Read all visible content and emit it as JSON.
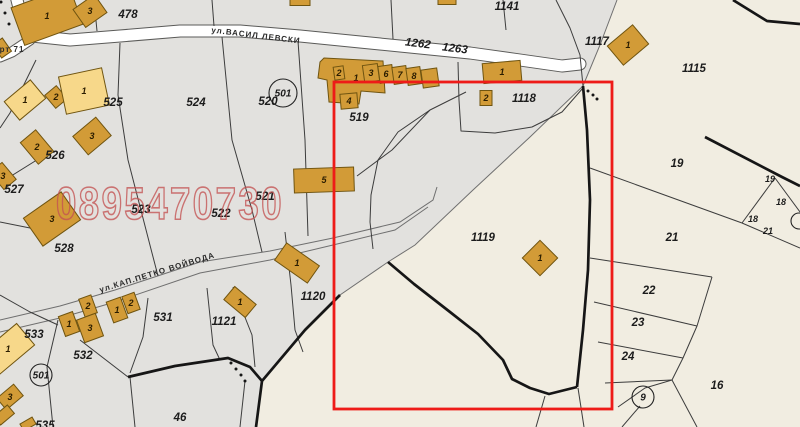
{
  "map": {
    "title": "cadastral-map",
    "colors": {
      "bg": "#e2e1de",
      "cream": "#f1ede1",
      "cream_edge": "#9a9a94",
      "road_fill": "#ffffff",
      "road_edge": "#5a5a58",
      "gray_line": "#6f6f6f",
      "thin_line": "#3c3c3c",
      "thick_line": "#161616",
      "building_fill": "#d29b37",
      "building_fill_light": "#f7d88a",
      "building_stroke": "#6f5410",
      "red_box": "#ee1b18",
      "watermark": "#c45353",
      "label": "#1c1c1c"
    },
    "cream_polygon": "617,0 800,0 800,427 256,427 262,381 305,330 340,295 388,262 415,245 473,190 530,137 583,86 600,45",
    "roads": [
      {
        "pts": "16,-4 22,20 32,36 70,40 120,36 180,31 240,31 300,36 360,42 420,48 470,53 520,60 562,66 580,64",
        "w": 11
      },
      {
        "pts": "30,40 12,52 0,57",
        "w": 9
      }
    ],
    "gray_lines": [
      "617,0 600,45 583,86 530,137 473,190 415,245 388,262 340,295 305,330 262,381 256,427",
      "0,320 60,306 115,290 200,262 270,251 333,238 400,222 433,200 437,187",
      "0,332 60,318 115,302 200,273 270,260 333,245 395,230 428,207"
    ],
    "thin_lines": [
      "120,43 118,95 128,160 152,253 158,276",
      "36,60 10,113 0,128",
      "40,158 0,183",
      "0,222 50,232",
      "222,37 232,140 252,210 262,252",
      "298,41 305,140 308,236",
      "466,92 430,110 398,132 378,160 371,195 370,222 373,249",
      "357,176 392,150 430,110",
      "458,62 459,100 461,131 495,133 532,127 562,112 583,88",
      "285,232 291,285 295,330 303,352",
      "148,298 143,337 130,373",
      "207,288 213,345 220,360",
      "233,287 252,335 255,367",
      "58,320 47,367 53,427",
      "80,340 128,377",
      "130,377 135,427",
      "245,381 240,427",
      "0,295 30,312 58,325",
      "590,168 742,223",
      "742,223 775,178",
      "775,178 800,212",
      "742,223 800,248",
      "590,258 712,277",
      "594,302 697,326",
      "598,342 683,358",
      "605,383 672,380",
      "712,277 697,326 683,358 672,380 645,388 618,407",
      "640,406 622,427",
      "672,380 697,427",
      "578,388 584,427",
      "545,396 536,427",
      "556,0 570,28 580,55 583,86",
      "97,31 94,0",
      "212,0 214,26",
      "391,0 393,39",
      "503,0 506,30"
    ],
    "thick_lines": [
      "733,0 767,21 800,24",
      "705,137 782,177 800,186",
      "583,86 587,130 590,200 588,270 583,330 577,387",
      "388,262 414,284 450,312 478,334 503,360 512,379 530,388 549,394 577,387",
      "128,377 175,366 228,358 250,367 262,381",
      "340,295 305,330 262,381 256,427"
    ],
    "dots": [
      [
        1,
        2
      ],
      [
        5,
        13
      ],
      [
        9,
        24
      ],
      [
        588,
        91
      ],
      [
        593,
        95
      ],
      [
        597,
        99
      ],
      [
        231,
        363
      ],
      [
        236,
        369
      ],
      [
        241,
        375
      ],
      [
        245,
        381
      ]
    ],
    "buildings": [
      {
        "x": 47,
        "y": 16,
        "w": 62,
        "h": 40,
        "r": -20,
        "l": "1"
      },
      {
        "x": 90,
        "y": 11,
        "w": 26,
        "h": 22,
        "r": -35,
        "l": "3"
      },
      {
        "x": 2,
        "y": 48,
        "w": 12,
        "h": 16,
        "r": -35,
        "l": ""
      },
      {
        "x": 25,
        "y": 100,
        "w": 34,
        "h": 24,
        "r": -40,
        "l": "1",
        "lt": 1
      },
      {
        "x": 56,
        "y": 97,
        "w": 15,
        "h": 17,
        "r": -40,
        "l": "2"
      },
      {
        "x": 84,
        "y": 91,
        "w": 44,
        "h": 38,
        "r": -12,
        "l": "1",
        "lt": 1
      },
      {
        "x": 92,
        "y": 136,
        "w": 30,
        "h": 24,
        "r": -40,
        "l": "3"
      },
      {
        "x": 37,
        "y": 147,
        "w": 20,
        "h": 28,
        "r": -40,
        "l": "2"
      },
      {
        "x": 3,
        "y": 176,
        "w": 16,
        "h": 22,
        "r": -40,
        "l": "3"
      },
      {
        "x": 52,
        "y": 219,
        "w": 46,
        "h": 34,
        "r": -35,
        "l": "3"
      },
      {
        "x": 8,
        "y": 349,
        "w": 46,
        "h": 28,
        "r": -40,
        "l": "1",
        "lt": 1
      },
      {
        "x": 10,
        "y": 397,
        "w": 22,
        "h": 15,
        "r": -40,
        "l": "3"
      },
      {
        "x": 4,
        "y": 415,
        "w": 18,
        "h": 11,
        "r": -40,
        "l": ""
      },
      {
        "x": 28,
        "y": 424,
        "w": 14,
        "h": 8,
        "r": -30,
        "l": ""
      },
      {
        "x": 88,
        "y": 306,
        "w": 13,
        "h": 19,
        "r": -20,
        "l": "2"
      },
      {
        "x": 69,
        "y": 324,
        "w": 15,
        "h": 21,
        "r": -20,
        "l": "1"
      },
      {
        "x": 90,
        "y": 328,
        "w": 20,
        "h": 24,
        "r": -20,
        "l": "3"
      },
      {
        "x": 117,
        "y": 310,
        "w": 15,
        "h": 22,
        "r": -20,
        "l": "1"
      },
      {
        "x": 131,
        "y": 303,
        "w": 13,
        "h": 18,
        "r": -20,
        "l": "2"
      },
      {
        "x": 240,
        "y": 302,
        "w": 17,
        "h": 28,
        "r": -50,
        "l": "1"
      },
      {
        "pts": "324,58 383,61 385,93 361,91 359,104 329,102 327,80 318,78 320,62",
        "l": "1",
        "lx": 356,
        "ly": 78
      },
      {
        "x": 339,
        "y": 73,
        "w": 10,
        "h": 13,
        "r": -8,
        "l": "2"
      },
      {
        "x": 371,
        "y": 73,
        "w": 15,
        "h": 17,
        "r": -8,
        "l": "3"
      },
      {
        "x": 386,
        "y": 74,
        "w": 14,
        "h": 17,
        "r": -8,
        "l": "6"
      },
      {
        "x": 400,
        "y": 75,
        "w": 14,
        "h": 17,
        "r": -8,
        "l": "7"
      },
      {
        "x": 414,
        "y": 76,
        "w": 14,
        "h": 17,
        "r": -8,
        "l": "8"
      },
      {
        "x": 430,
        "y": 78,
        "w": 16,
        "h": 18,
        "r": -8,
        "l": ""
      },
      {
        "x": 349,
        "y": 101,
        "w": 17,
        "h": 15,
        "r": -5,
        "l": "4"
      },
      {
        "x": 502,
        "y": 72,
        "w": 38,
        "h": 20,
        "r": -5,
        "l": "1"
      },
      {
        "x": 486,
        "y": 98,
        "w": 12,
        "h": 15,
        "r": 0,
        "l": "2"
      },
      {
        "x": 324,
        "y": 180,
        "w": 60,
        "h": 24,
        "r": -2,
        "l": "5"
      },
      {
        "x": 297,
        "y": 263,
        "w": 21,
        "h": 40,
        "r": -55,
        "l": "1"
      },
      {
        "x": 540,
        "y": 258,
        "w": 25,
        "h": 25,
        "r": 45,
        "l": "1"
      },
      {
        "x": 628,
        "y": 45,
        "w": 33,
        "h": 25,
        "r": -40,
        "l": "1"
      },
      {
        "x": 300,
        "y": 2,
        "w": 20,
        "h": 7,
        "r": 0,
        "l": ""
      },
      {
        "x": 447,
        "y": 2,
        "w": 18,
        "h": 5,
        "r": 0,
        "l": ""
      }
    ],
    "circles": [
      {
        "x": 283,
        "y": 93,
        "rad": 14,
        "l": "501"
      },
      {
        "x": 41,
        "y": 375,
        "rad": 11,
        "l": "501"
      },
      {
        "x": 643,
        "y": 397,
        "rad": 11,
        "l": "9"
      },
      {
        "x": 799,
        "y": 221,
        "rad": 8,
        "l": ""
      }
    ],
    "parcel_labels": [
      {
        "t": "478",
        "x": 128,
        "y": 14
      },
      {
        "t": "1141",
        "x": 507,
        "y": 6
      },
      {
        "t": "1262",
        "x": 418,
        "y": 43,
        "rot": 7
      },
      {
        "t": "1263",
        "x": 455,
        "y": 48,
        "rot": 7
      },
      {
        "t": "1117",
        "x": 597,
        "y": 41
      },
      {
        "t": "1115",
        "x": 694,
        "y": 68
      },
      {
        "t": "1118",
        "x": 524,
        "y": 98
      },
      {
        "t": "519",
        "x": 359,
        "y": 117
      },
      {
        "t": "520",
        "x": 268,
        "y": 101
      },
      {
        "t": "525",
        "x": 113,
        "y": 102
      },
      {
        "t": "524",
        "x": 196,
        "y": 102
      },
      {
        "t": "521",
        "x": 265,
        "y": 196
      },
      {
        "t": "523",
        "x": 141,
        "y": 209
      },
      {
        "t": "522",
        "x": 221,
        "y": 213
      },
      {
        "t": "526",
        "x": 55,
        "y": 155
      },
      {
        "t": "527",
        "x": 14,
        "y": 189
      },
      {
        "t": "528",
        "x": 64,
        "y": 248
      },
      {
        "t": "533",
        "x": 34,
        "y": 334
      },
      {
        "t": "532",
        "x": 83,
        "y": 355
      },
      {
        "t": "531",
        "x": 163,
        "y": 317
      },
      {
        "t": "1121",
        "x": 224,
        "y": 321
      },
      {
        "t": "1120",
        "x": 313,
        "y": 296
      },
      {
        "t": "1119",
        "x": 483,
        "y": 237
      },
      {
        "t": "46",
        "x": 180,
        "y": 417
      },
      {
        "t": "535",
        "x": 45,
        "y": 425
      },
      {
        "t": "19",
        "x": 677,
        "y": 163
      },
      {
        "t": "19",
        "x": 770,
        "y": 178,
        "s": 9
      },
      {
        "t": "18",
        "x": 781,
        "y": 201,
        "s": 9
      },
      {
        "t": "18",
        "x": 753,
        "y": 218,
        "s": 9
      },
      {
        "t": "21",
        "x": 768,
        "y": 230,
        "s": 9
      },
      {
        "t": "21",
        "x": 672,
        "y": 237
      },
      {
        "t": "22",
        "x": 649,
        "y": 290
      },
      {
        "t": "23",
        "x": 638,
        "y": 322
      },
      {
        "t": "24",
        "x": 628,
        "y": 356
      },
      {
        "t": "16",
        "x": 717,
        "y": 385
      }
    ],
    "street_labels": [
      {
        "t": "ул.ВАСИЛ ЛЕВСКИ",
        "x": 256,
        "y": 35,
        "rot": 7,
        "s": 8
      },
      {
        "t": "ул.КАП.ПЕТКО ВОЙВОДА",
        "x": 157,
        "y": 272,
        "rot": -17,
        "s": 8
      },
      {
        "t": "рт 71",
        "x": 12,
        "y": 49,
        "rot": 0,
        "s": 8
      }
    ],
    "red_box": {
      "x": 334,
      "y": 82,
      "w": 278,
      "h": 327,
      "stroke_width": 2.8
    },
    "watermark": {
      "text": "0895470730",
      "x": 170,
      "y": 219,
      "size": 45,
      "length": 228,
      "opacity": 0.78
    }
  }
}
